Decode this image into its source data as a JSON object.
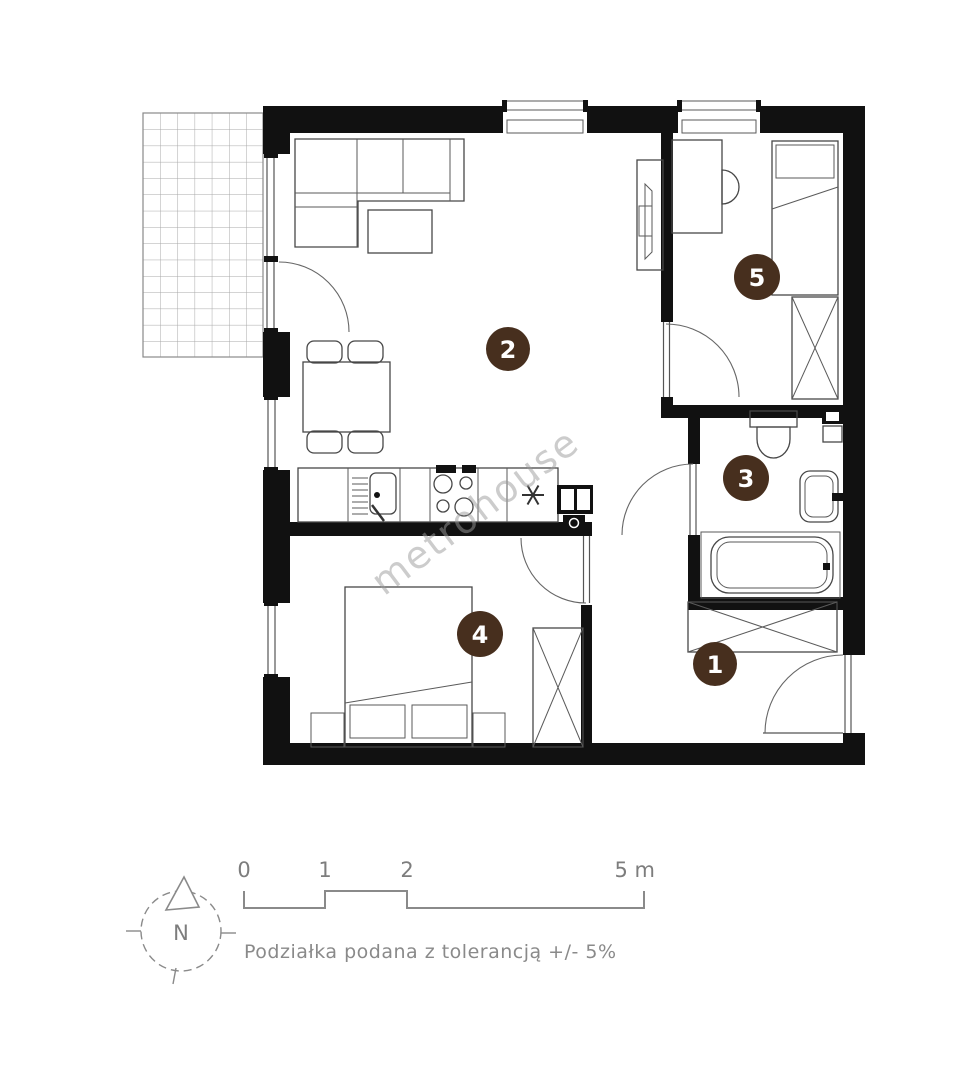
{
  "plan": {
    "watermark": "metrohouse",
    "rooms": [
      {
        "number": "1"
      },
      {
        "number": "2"
      },
      {
        "number": "3"
      },
      {
        "number": "4"
      },
      {
        "number": "5"
      }
    ]
  },
  "footer": {
    "compass_label": "N",
    "scale_ticks": [
      "0",
      "1",
      "2",
      "5 m"
    ],
    "tolerance_note": "Podziałka podana z tolerancją +/- 5%"
  },
  "colors": {
    "wall": "#111111",
    "room_badge": "#472f1e",
    "badge_text": "#ffffff",
    "furniture_line": "#474747",
    "annotation_gray": "#7d7d7d",
    "watermark_gray": "#9b9b9b"
  }
}
